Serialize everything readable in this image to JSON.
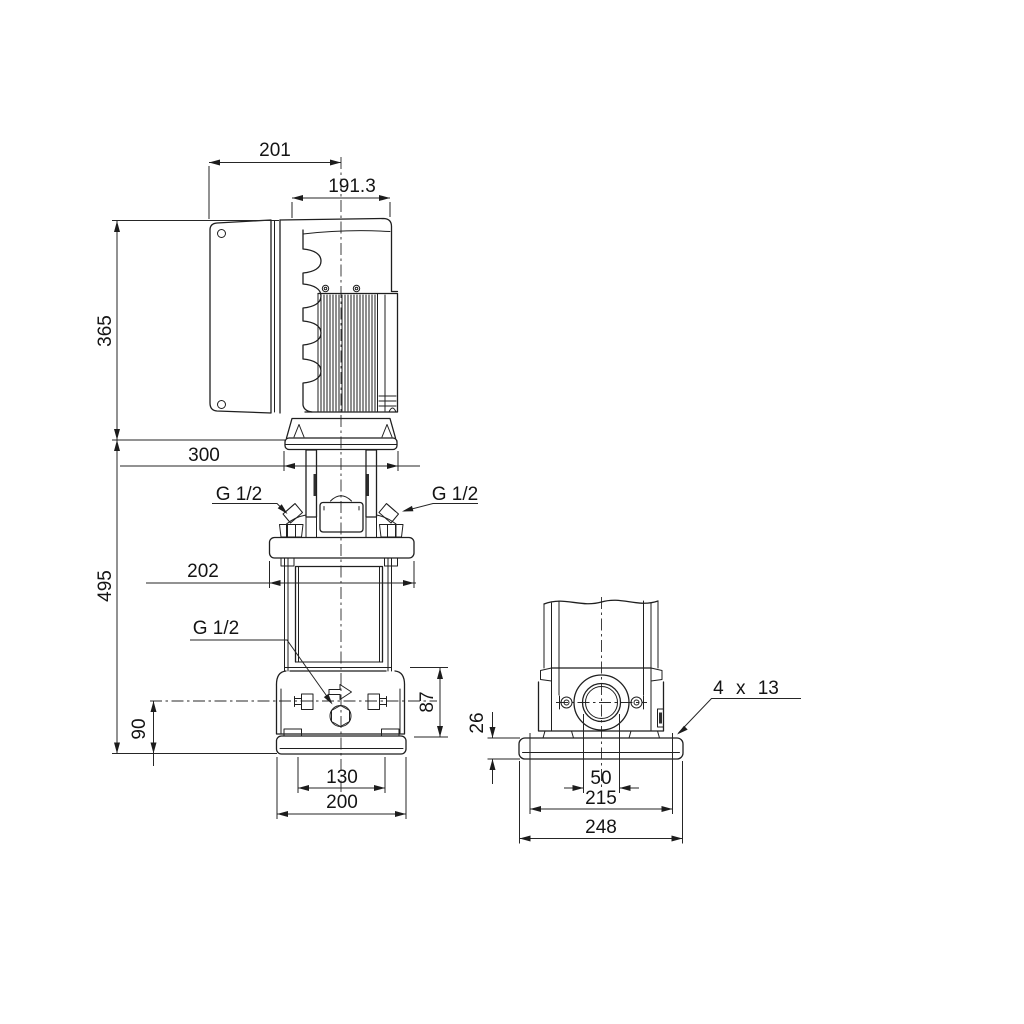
{
  "meta": {
    "background": "#ffffff",
    "line_color": "#1f1f1f",
    "dimension_color": "#262626"
  },
  "dims": {
    "d201": "201",
    "d191_3": "191.3",
    "d365": "365",
    "d300": "300",
    "d495": "495",
    "g12_left": "G 1/2",
    "g12_right": "G 1/2",
    "g12_drain": "G 1/2",
    "d202": "202",
    "d90": "90",
    "d87": "87",
    "d130": "130",
    "d200": "200",
    "d26": "26",
    "holes": "4 x 13",
    "d50": "50",
    "d215": "215",
    "d248": "248"
  }
}
